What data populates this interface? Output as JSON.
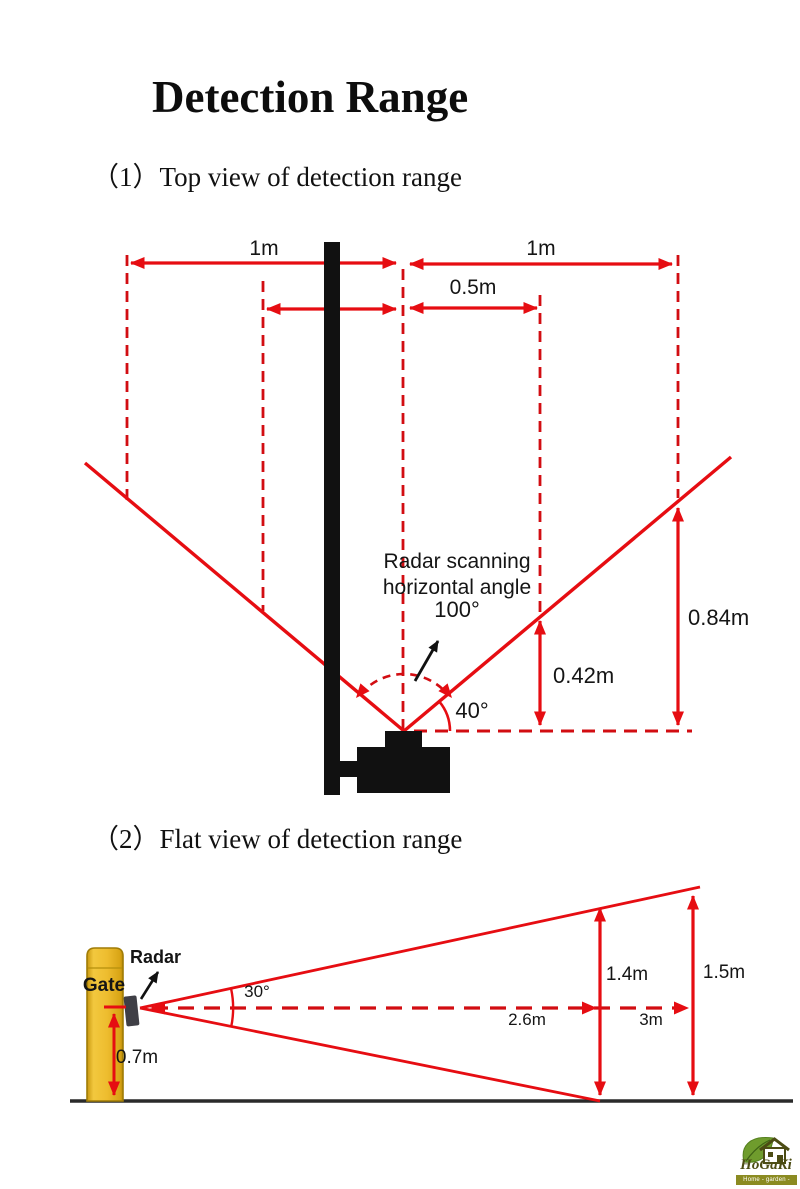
{
  "title": "Detection Range",
  "sections": {
    "top_view_heading": "（1）Top view of detection range",
    "flat_view_heading": "（2）Flat view of detection range"
  },
  "top_view": {
    "left_width_label": "1m",
    "right_width_label": "1m",
    "half_width_label": "0.5m",
    "scan_note_line1": "Radar scanning",
    "scan_note_line2": "horizontal angle",
    "scan_angle_label": "100°",
    "beam_elevation_label": "40°",
    "near_height_label": "0.42m",
    "far_height_label": "0.84m"
  },
  "flat_view": {
    "gate_label": "Gate",
    "radar_label": "Radar",
    "beam_angle_label": "30°",
    "mount_height_label": "0.7m",
    "mid_distance_label": "2.6m",
    "max_distance_label": "3m",
    "mid_height_label": "1.4m",
    "max_height_label": "1.5m"
  },
  "logo": {
    "brand": "HoGaKi",
    "tagline": "Home - garden - kitchen"
  },
  "colors": {
    "red": "#e60d12",
    "dash_red": "#d20d12",
    "ink": "#111111",
    "gate_fill": "#eebd2f",
    "gate_border": "#a07c06",
    "radar_gray": "#3f3f46",
    "ground": "#2a2a2a",
    "logo_olive": "#4c4c14",
    "banner_olive": "#8b8b22",
    "leaf_green": "#6f9c2d"
  }
}
